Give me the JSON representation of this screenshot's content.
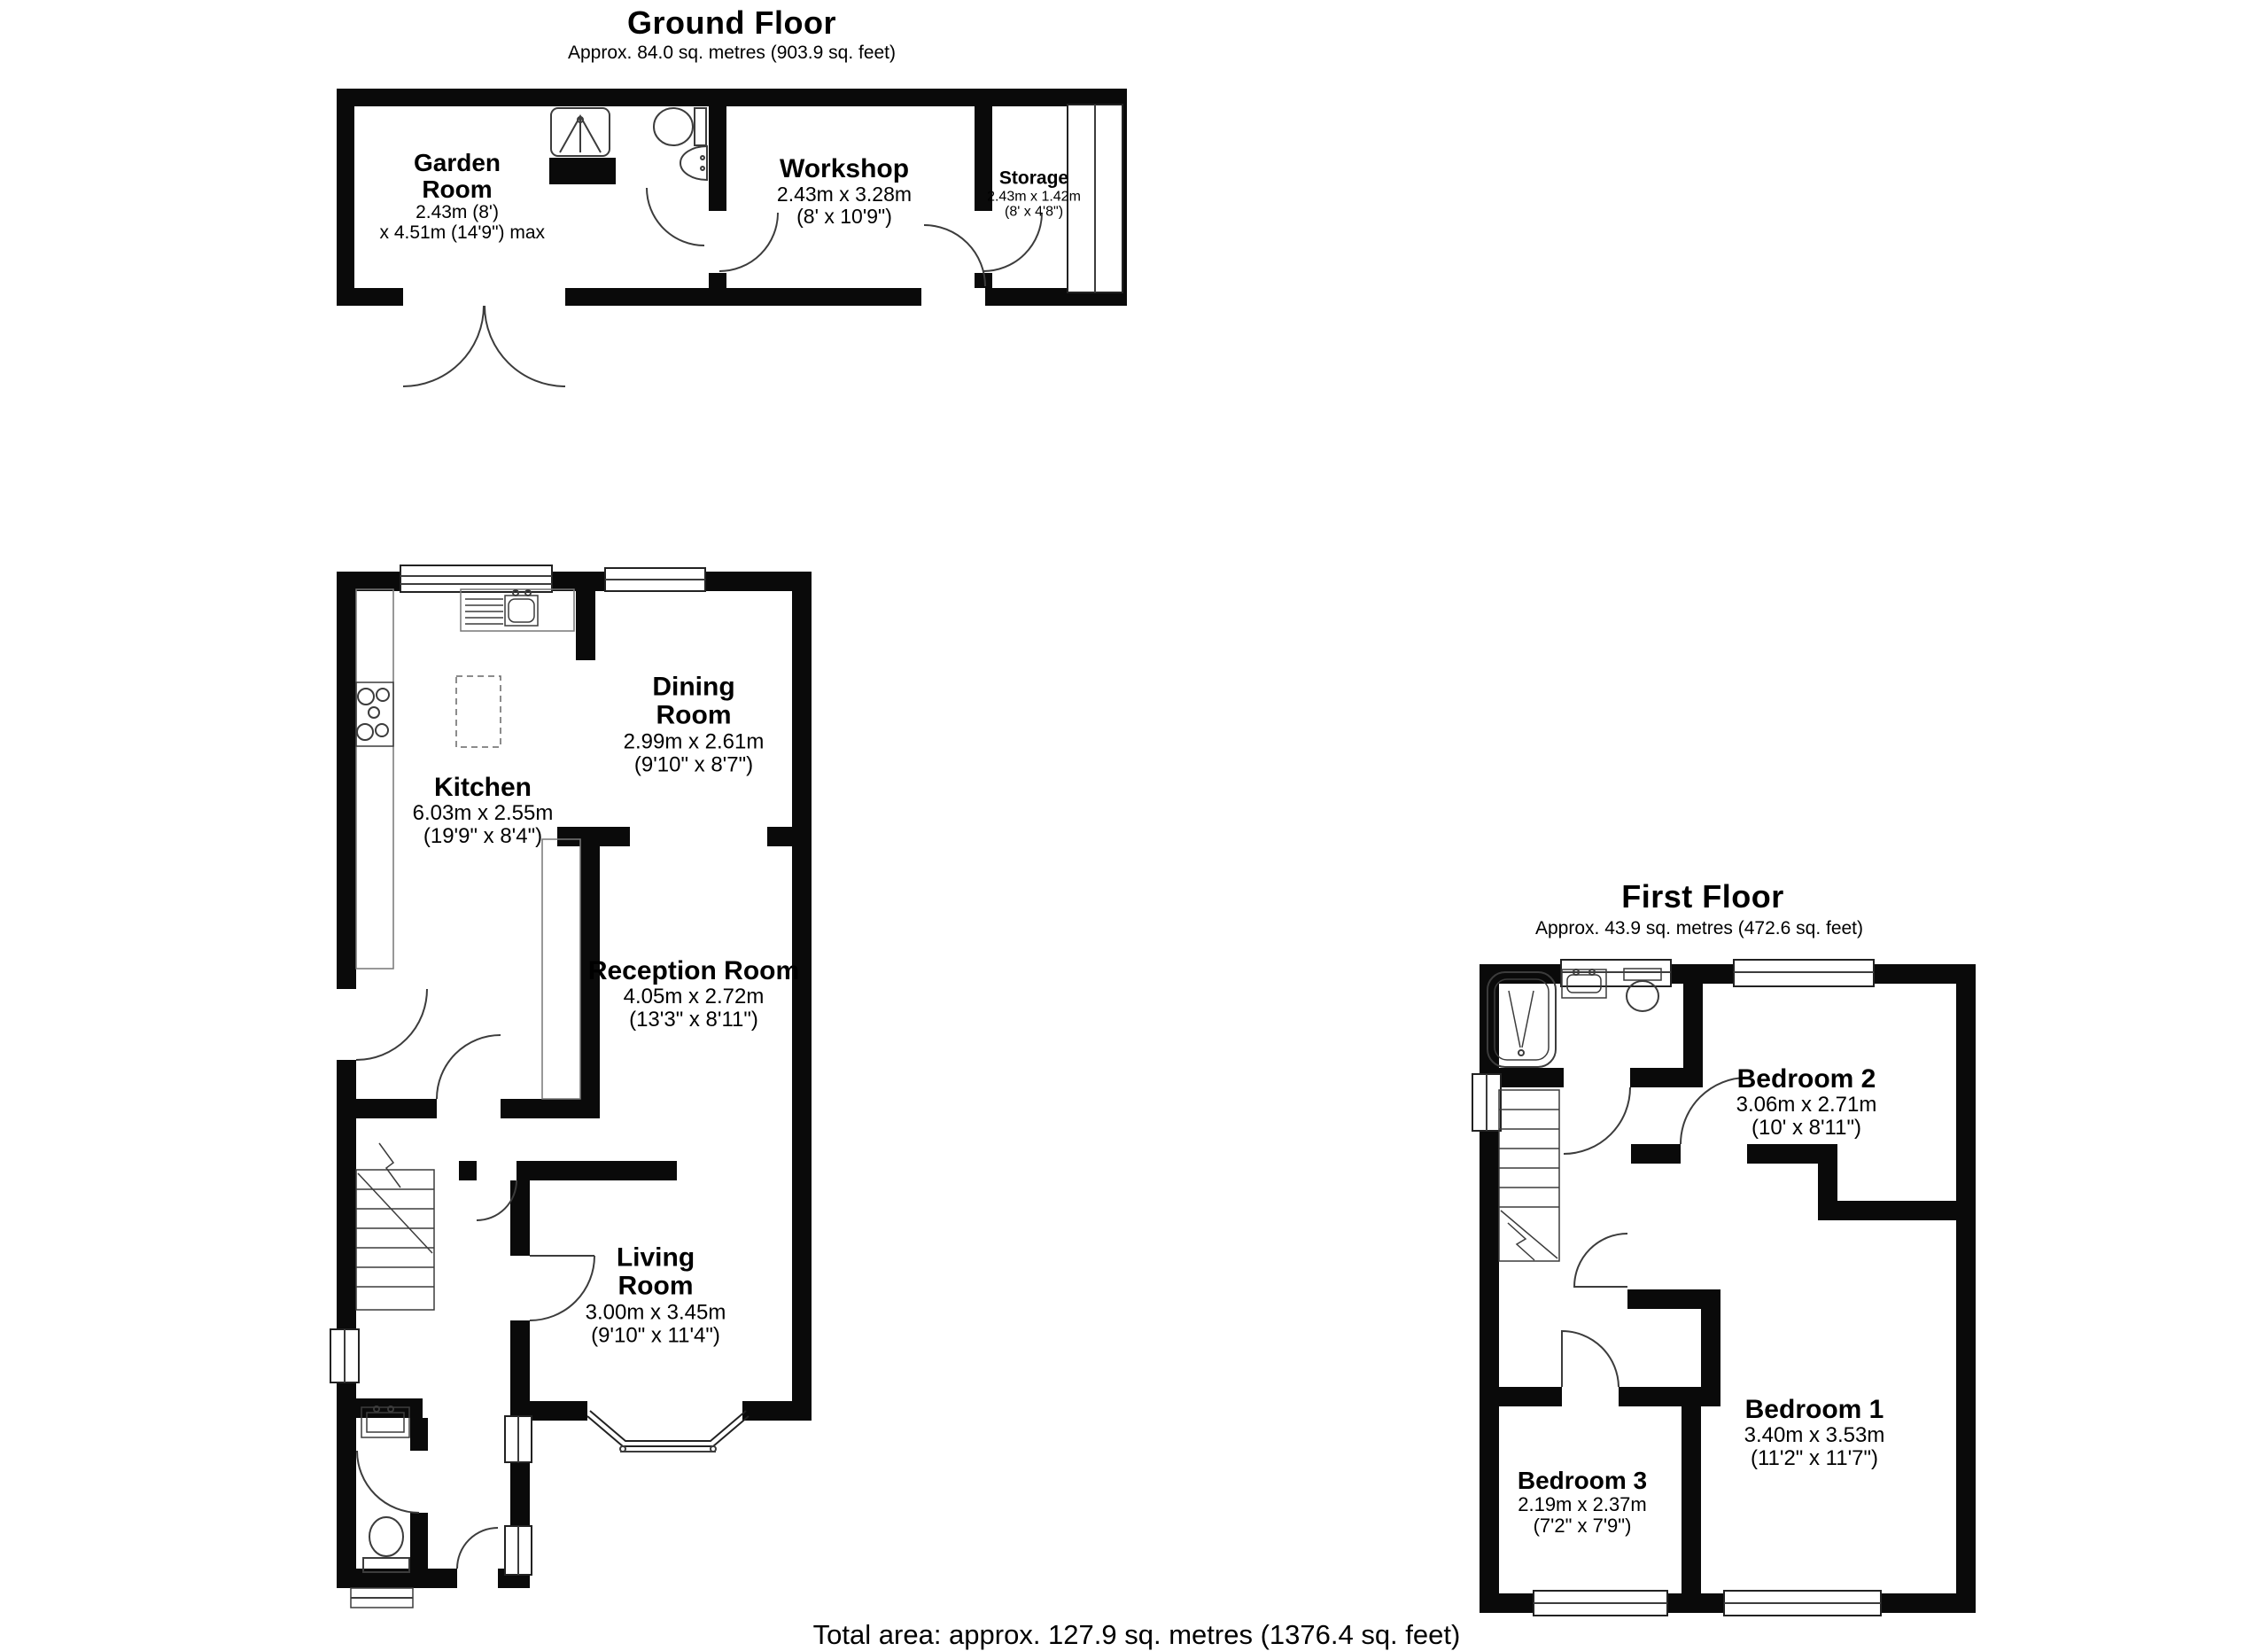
{
  "ground_floor": {
    "title": "Ground Floor",
    "subtitle": "Approx. 84.0 sq. metres (903.9 sq. feet)"
  },
  "first_floor": {
    "title": "First Floor",
    "subtitle": "Approx. 43.9 sq. metres (472.6 sq. feet)"
  },
  "footer": {
    "total_area": "Total area: approx. 127.9 sq. metres (1376.4 sq. feet)"
  },
  "rooms": {
    "garden_room": {
      "name": "Garden Room",
      "dim_metric": "2.43m (8')",
      "dim_imperial": "x 4.51m (14'9\") max"
    },
    "workshop": {
      "name": "Workshop",
      "dim_metric": "2.43m x 3.28m",
      "dim_imperial": "(8' x 10'9\")"
    },
    "storage": {
      "name": "Storage",
      "dim_metric": "2.43m x 1.42m",
      "dim_imperial": "(8' x 4'8\")"
    },
    "kitchen": {
      "name": "Kitchen",
      "dim_metric": "6.03m x 2.55m",
      "dim_imperial": "(19'9\" x 8'4\")"
    },
    "dining_room": {
      "name": "Dining Room",
      "dim_metric": "2.99m x 2.61m",
      "dim_imperial": "(9'10\" x 8'7\")"
    },
    "reception_room": {
      "name": "Reception Room",
      "dim_metric": "4.05m x 2.72m",
      "dim_imperial": "(13'3\" x 8'11\")"
    },
    "living_room": {
      "name": "Living Room",
      "dim_metric": "3.00m x 3.45m",
      "dim_imperial": "(9'10\" x 11'4\")"
    },
    "bedroom_2": {
      "name": "Bedroom 2",
      "dim_metric": "3.06m x 2.71m",
      "dim_imperial": "(10' x 8'11\")"
    },
    "bedroom_1": {
      "name": "Bedroom 1",
      "dim_metric": "3.40m x 3.53m",
      "dim_imperial": "(11'2\" x 11'7\")"
    },
    "bedroom_3": {
      "name": "Bedroom 3",
      "dim_metric": "2.19m x 2.37m",
      "dim_imperial": "(7'2\" x 7'9\")"
    }
  }
}
